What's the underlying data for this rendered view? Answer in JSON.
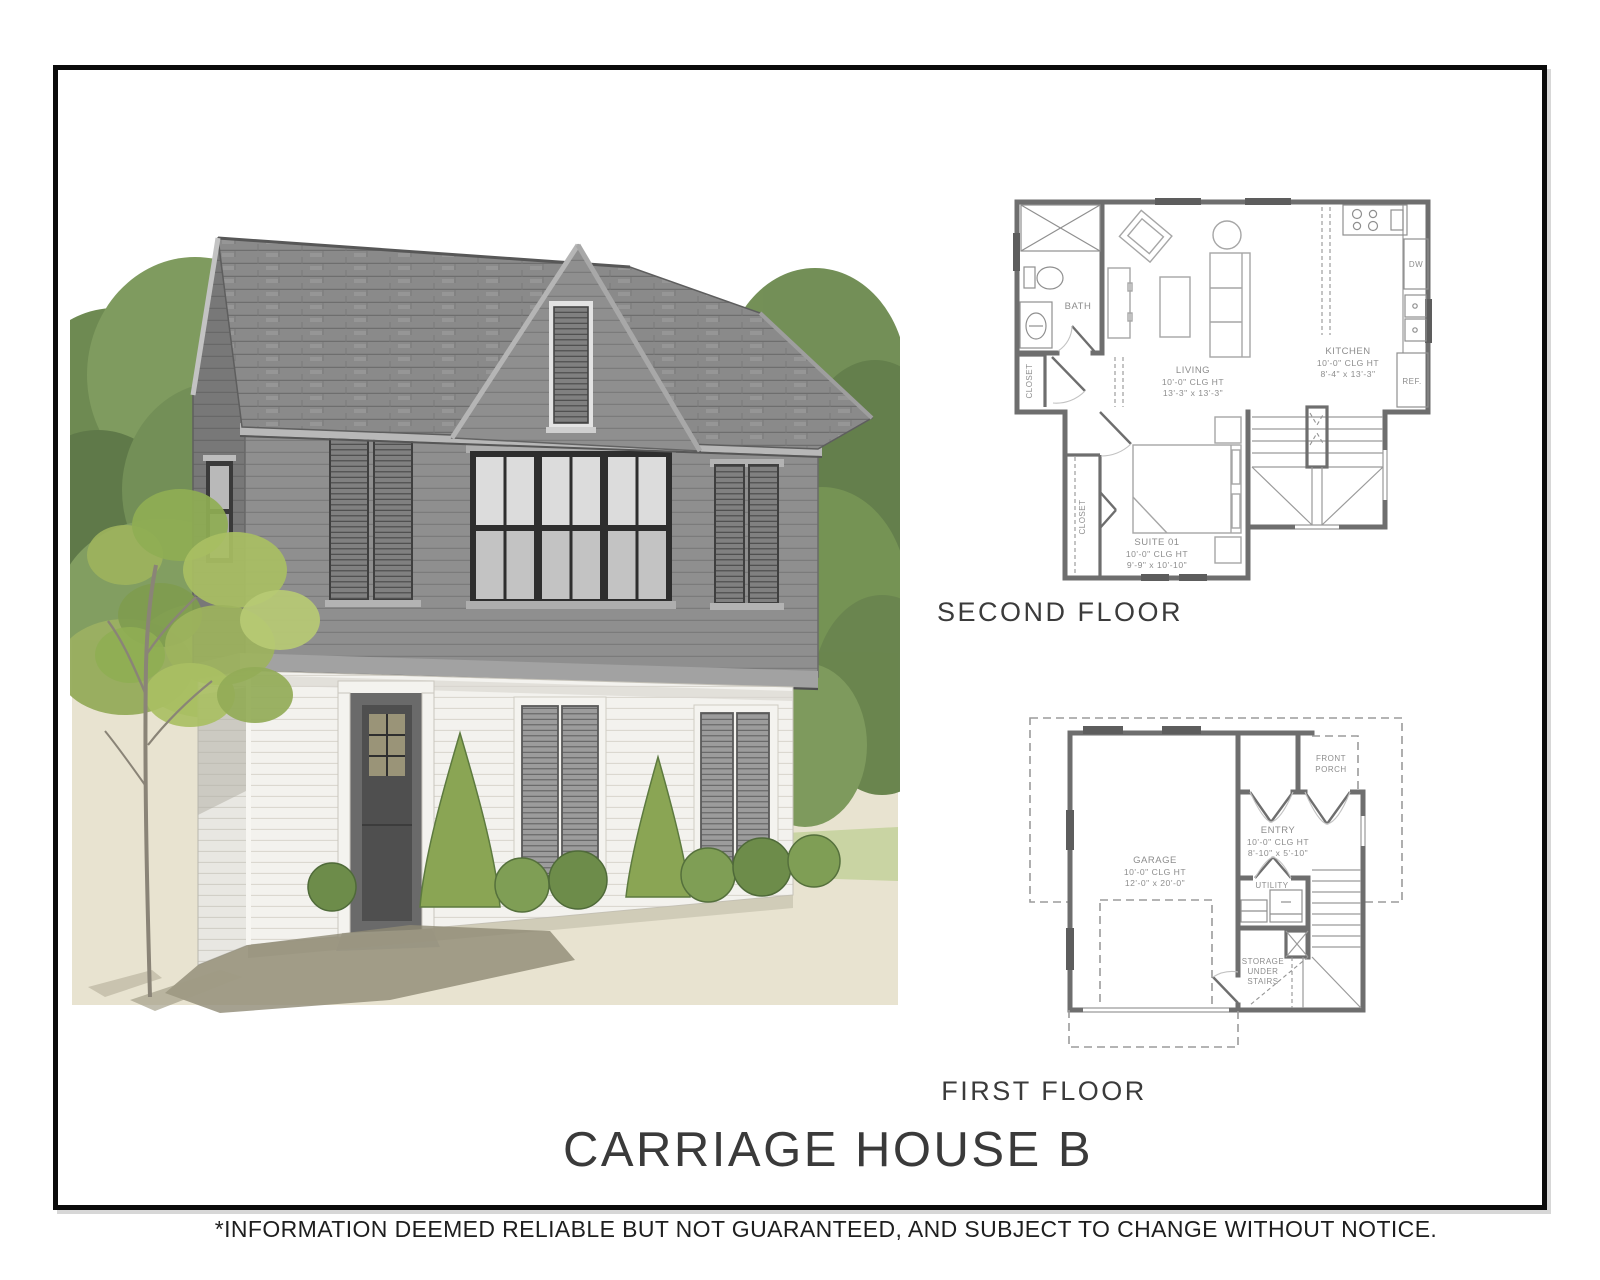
{
  "sheet": {
    "title": "CARRIAGE HOUSE B",
    "disclaimer": "*INFORMATION DEEMED RELIABLE BUT NOT GUARANTEED, AND SUBJECT TO CHANGE WITHOUT NOTICE."
  },
  "second_floor": {
    "caption": "SECOND FLOOR",
    "bath": "BATH",
    "hall_closet": "CLOSET",
    "suite_closet": "CLOSET",
    "dishwasher": "DW",
    "refrigerator": "REF.",
    "living": {
      "name": "LIVING",
      "ceiling": "10'-0\" CLG HT",
      "dims": "13'-3\" x 13'-3\""
    },
    "kitchen": {
      "name": "KITCHEN",
      "ceiling": "10'-0\" CLG HT",
      "dims": "8'-4\" x 13'-3\""
    },
    "suite": {
      "name": "SUITE 01",
      "ceiling": "10'-0\" CLG HT",
      "dims": "9'-9\" x 10'-10\""
    }
  },
  "first_floor": {
    "caption": "FIRST FLOOR",
    "garage": {
      "name": "GARAGE",
      "ceiling": "10'-0\" CLG HT",
      "dims": "12'-0\" x 20'-0\""
    },
    "entry": {
      "name": "ENTRY",
      "ceiling": "10'-0\" CLG HT",
      "dims": "8'-10\" x 5'-10\""
    },
    "utility": "UTILITY",
    "storage": {
      "l1": "STORAGE",
      "l2": "UNDER",
      "l3": "STAIRS"
    },
    "porch": {
      "l1": "FRONT",
      "l2": "PORCH"
    }
  },
  "palette": {
    "frame_border": "#0b0b0b",
    "plan_wall": "#6e6e6e",
    "plan_text": "#8d8d8d",
    "roof": "#898989",
    "upper_siding": "#8f8f8f",
    "upper_siding_shade": "#777777",
    "lower_siding": "#f3f2ee",
    "window_frame": "#2e2e2e",
    "foliage_dark": "#5c7743",
    "foliage_mid": "#78954f",
    "foliage_light": "#a9bf63",
    "grass": "#c9d4a2",
    "ground": "#e8e3d0",
    "shadow": "#8f8a74"
  }
}
